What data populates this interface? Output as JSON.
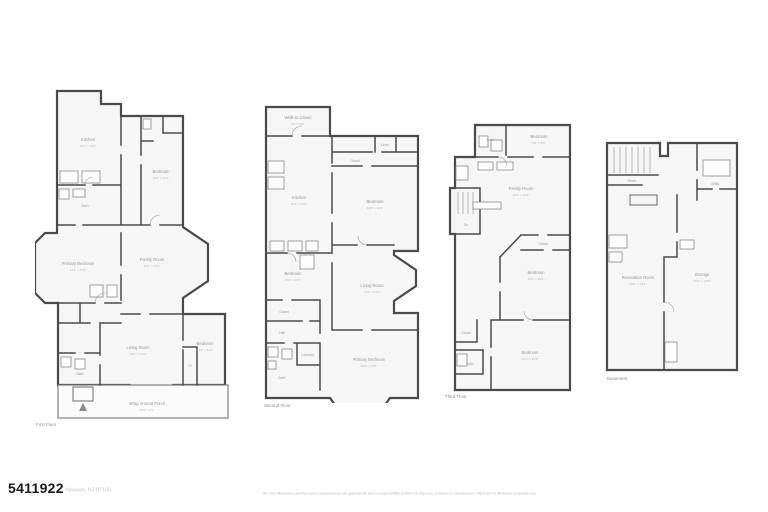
{
  "colors": {
    "wall": "#4a4a4a",
    "fixture": "#8a8a8a",
    "room_fill": "#f6f6f6",
    "label": "#979797",
    "mls_text": "#1b1b1b"
  },
  "footer": {
    "mls_number": "5411922",
    "address": "Newark, NJ 07106",
    "disclaimer": "All room dimensions and floor plan measurements are approximate and no responsibility is taken for any error, omission or misstatement. Plans are for illustration purposes only."
  },
  "floors": {
    "first": {
      "caption": "First Floor",
      "rooms": {
        "kitchen": {
          "name": "Kitchen",
          "dims": "12'4\" x 11'8\""
        },
        "bath1": {
          "name": "Bath"
        },
        "bedroom_top": {
          "name": "Bedroom",
          "dims": "11'6\" x 12'2\""
        },
        "primary": {
          "name": "Primary Bedroom",
          "dims": "14'1\" x 11'3\""
        },
        "family": {
          "name": "Family Room",
          "dims": "15'2\" x 13'6\""
        },
        "living": {
          "name": "Living Room",
          "dims": "13'4\" x 12'0\""
        },
        "bedroom_br": {
          "name": "Bedroom",
          "dims": "10'8\" x 11'2\""
        },
        "closet": {
          "name": "Cl"
        },
        "bath3": {
          "name": "Bath"
        },
        "porch": {
          "name": "Wrap Around Porch",
          "dims": "32'0\" x 6'4\""
        }
      }
    },
    "second": {
      "caption": "Second Floor",
      "rooms": {
        "wic": {
          "name": "Walk-In Closet",
          "dims": "8'2\" x 5'6\""
        },
        "kitchen": {
          "name": "Kitchen",
          "dims": "11'4\" x 12'6\""
        },
        "linen": {
          "name": "Linen"
        },
        "closet_strip": {
          "name": "Closet"
        },
        "bedroom_r": {
          "name": "Bedroom",
          "dims": "11'8\" x 12'4\""
        },
        "bedroom_l": {
          "name": "Bedroom",
          "dims": "9'6\" x 10'2\""
        },
        "closet2": {
          "name": "Closet"
        },
        "hall": {
          "name": "Hall"
        },
        "bath": {
          "name": "Bath"
        },
        "laundry": {
          "name": "Laundry"
        },
        "living": {
          "name": "Living Room",
          "dims": "14'6\" x 13'2\""
        },
        "primary": {
          "name": "Primary Bedroom",
          "dims": "15'0\" x 11'6\""
        }
      }
    },
    "third": {
      "caption": "Third Floor",
      "rooms": {
        "bath_top": {
          "name": "Bath"
        },
        "bedroom_top": {
          "name": "Bedroom",
          "dims": "9'2\" x 8'6\""
        },
        "family": {
          "name": "Family Room",
          "dims": "16'4\" x 12'2\""
        },
        "stairs": {
          "name": "Dn"
        },
        "closet_mid": {
          "name": "Closet"
        },
        "bedroom_mid": {
          "name": "Bedroom",
          "dims": "11'2\" x 10'6\""
        },
        "closet_bl": {
          "name": "Closet"
        },
        "bath_bl": {
          "name": "Bath"
        },
        "bedroom_bot": {
          "name": "Bedroom",
          "dims": "12'4\" x 10'8\""
        }
      }
    },
    "basement": {
      "caption": "Basement",
      "rooms": {
        "stairs": {
          "name": "Stairs"
        },
        "utility": {
          "name": "Utility"
        },
        "rec": {
          "name": "Recreation Room",
          "dims": "28'6\" x 13'4\""
        },
        "storage": {
          "name": "Storage",
          "dims": "26'2\" x 12'8\""
        }
      }
    }
  }
}
